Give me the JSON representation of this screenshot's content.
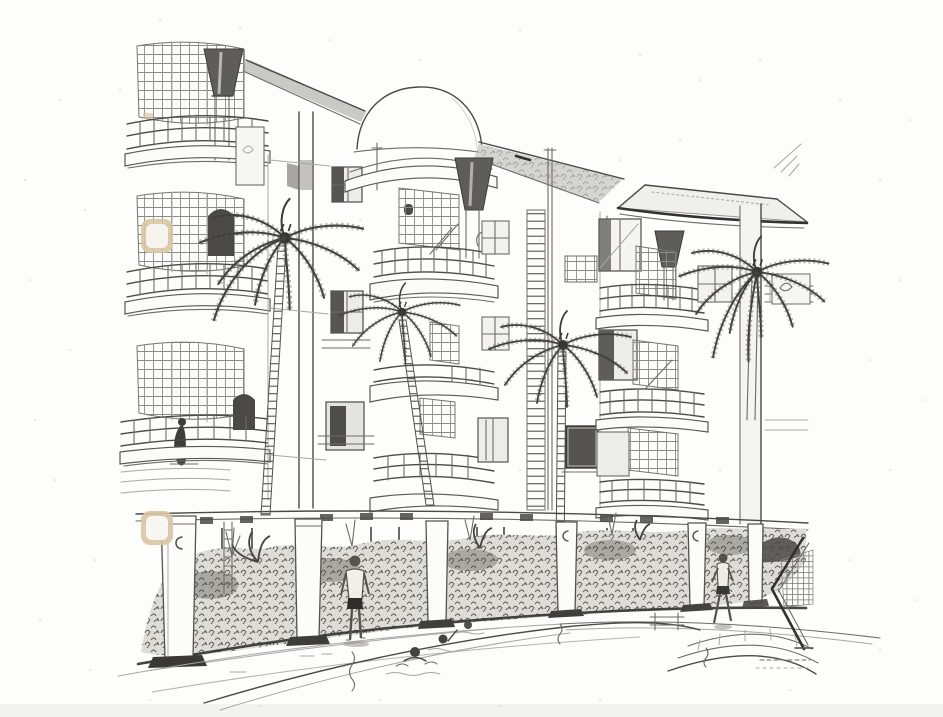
{
  "scene": {
    "alt": "Scanned hand-drawn architectural perspective sketch of a curved three-storey resort apartment building with a central dome, funnel-shaped column capitals, lattice-screened balconies, four palm trees, a ground-floor colonnade with dense planting, and a foreground swimming pool with swimmers and figures",
    "type": "architectural-perspective-sketch",
    "medium": "pencil-ink-photocopy-scan",
    "storeys_above_ground": 3,
    "palm_tree_count": 4,
    "figures": {
      "standing_by_pool": 1,
      "walking_by_pool": 1,
      "swimmers_in_pool": 3,
      "on_balcony": 1
    },
    "features": [
      "dome-roof",
      "hip-roof-wing",
      "funnel-column-capitals",
      "curved-balconies",
      "lattice-screens",
      "trellis-mast",
      "ground-colonnade",
      "planting-bed",
      "swimming-pool",
      "curved-pool-steps",
      "pool-ladder",
      "chevron-trellis-sculpture",
      "scan-artifacts"
    ],
    "palette": {
      "paper": "#fdfdfb",
      "ink": "#4c4a47",
      "ink_dark": "#343230",
      "soffit_shade": "#c9c9c6",
      "roof_shade": "#d4d4d1",
      "planting_base": "#ddddd8",
      "artifact_tan": "#d8c7a3",
      "bottom_strip": "#f0f0ee"
    }
  }
}
